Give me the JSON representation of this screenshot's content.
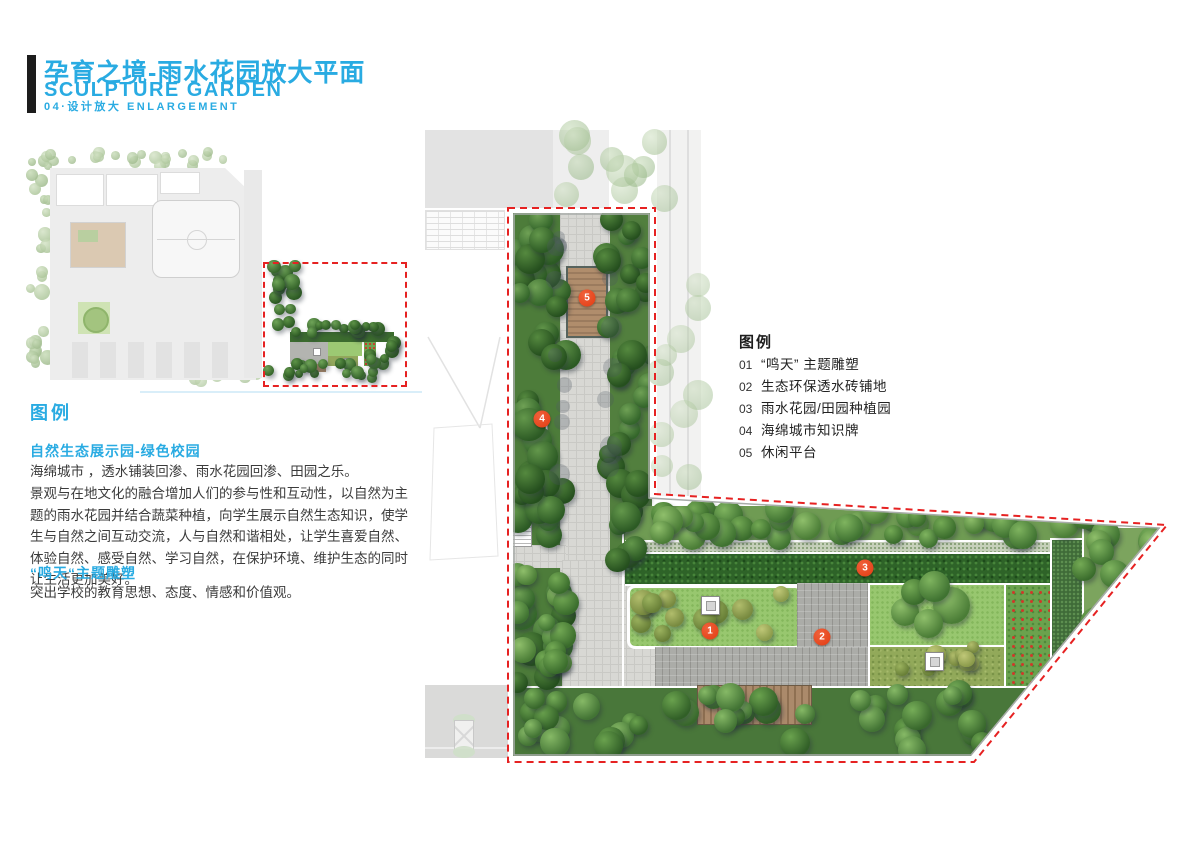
{
  "header": {
    "title_zh": "孕育之境-雨水花园放大平面",
    "title_en": "SCULPTURE GARDEN",
    "subtitle": "04·设计放大  ENLARGEMENT"
  },
  "left_panel": {
    "legend_heading": "图例",
    "section1_title": "自然生态展示园-绿色校园",
    "para1": "海绵城市 ，透水铺装回渗、雨水花园回渗、田园之乐。",
    "para2": "景观与在地文化的融合增加人们的参与性和互动性，以自然为主题的雨水花园并结合蔬菜种植，向学生展示自然生态知识，使学生与自然之间互动交流，人与自然和谐相处，让学生喜爱自然、体验自然、感受自然、学习自然，在保护环境、维护生态的同时让生活更加美好。",
    "section2_title": "“鸣天“主题雕塑",
    "para3": "突出学校的教育思想、态度、情感和价值观。"
  },
  "plan_legend": {
    "heading": "图例",
    "items": [
      {
        "num": "01",
        "label": "“鸣天” 主题雕塑"
      },
      {
        "num": "02",
        "label": "生态环保透水砖铺地"
      },
      {
        "num": "03",
        "label": "雨水花园/田园种植园"
      },
      {
        "num": "04",
        "label": "海绵城市知识牌"
      },
      {
        "num": "05",
        "label": "休闲平台"
      }
    ]
  },
  "markers": [
    {
      "num": "5",
      "x": 167,
      "y": 170
    },
    {
      "num": "4",
      "x": 122,
      "y": 291
    },
    {
      "num": "3",
      "x": 445,
      "y": 440
    },
    {
      "num": "1",
      "x": 290,
      "y": 503
    },
    {
      "num": "2",
      "x": 402,
      "y": 509
    }
  ],
  "colors": {
    "accent_blue": "#29abe2",
    "marker_red": "#e8431f",
    "boundary_red": "#e62222"
  }
}
